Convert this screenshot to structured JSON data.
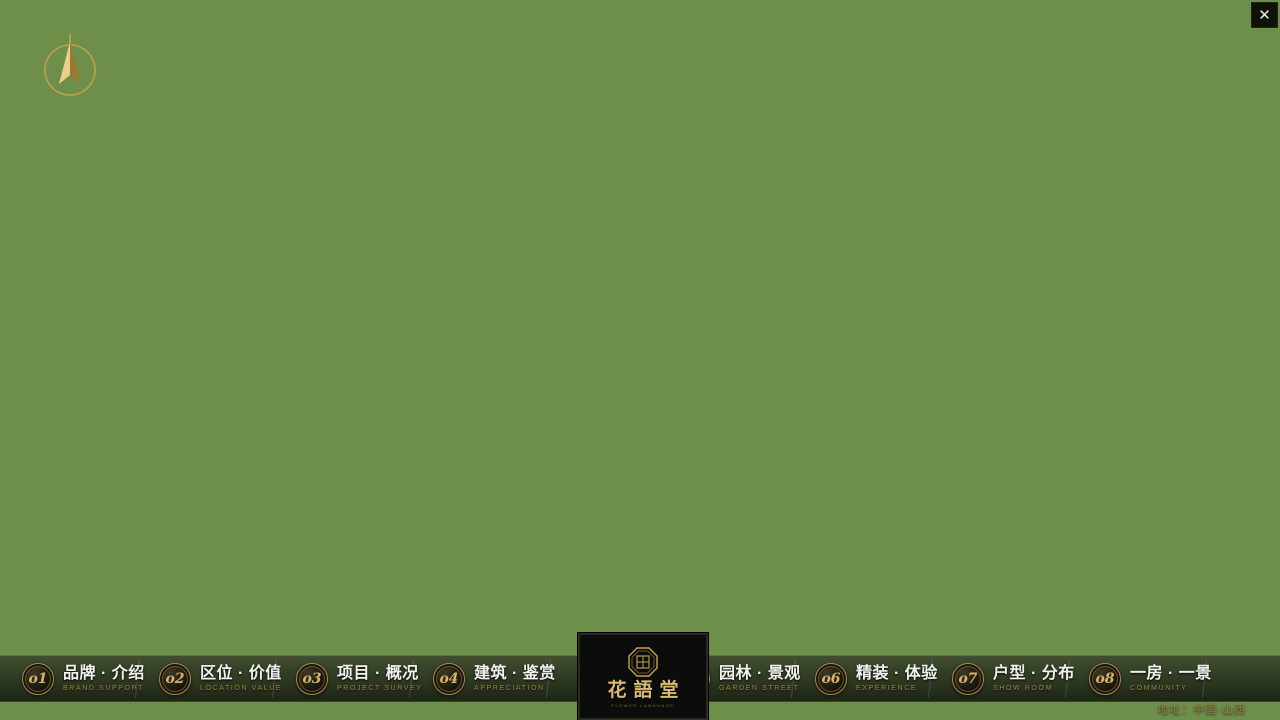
{
  "app": {
    "close_glyph": "✕"
  },
  "menu": {
    "items": [
      {
        "num": "o1",
        "zh": "品牌 · 介绍",
        "en": "BRAND SUPPORT"
      },
      {
        "num": "o2",
        "zh": "区位 · 价值",
        "en": "LOCATION VALUE"
      },
      {
        "num": "o3",
        "zh": "项目 · 概况",
        "en": "PROJECT SURVEY"
      },
      {
        "num": "o4",
        "zh": "建筑 · 鉴赏",
        "en": "APPRECIATION"
      },
      {
        "num": "o5",
        "zh": "园林 · 景观",
        "en": "GARDEN STREET"
      },
      {
        "num": "o6",
        "zh": "精装 · 体验",
        "en": "EXPERIENCE"
      },
      {
        "num": "o7",
        "zh": "户型 · 分布",
        "en": "SHOW ROOM"
      },
      {
        "num": "o8",
        "zh": "一房 · 一景",
        "en": "COMMUNITY"
      }
    ]
  },
  "logo": {
    "title": "花語堂",
    "subtitle": "FLOWER LANGUAGE"
  },
  "footer": {
    "address": "地址：中国·山西"
  },
  "colors": {
    "brand_gold": "#b9934a",
    "nav_en_gold": "#a6853e",
    "grass": "#7fae4e",
    "forest": "#24451c",
    "water": "#3e6cb0",
    "road": "#b5babe",
    "building_white": "#eef1f4"
  }
}
